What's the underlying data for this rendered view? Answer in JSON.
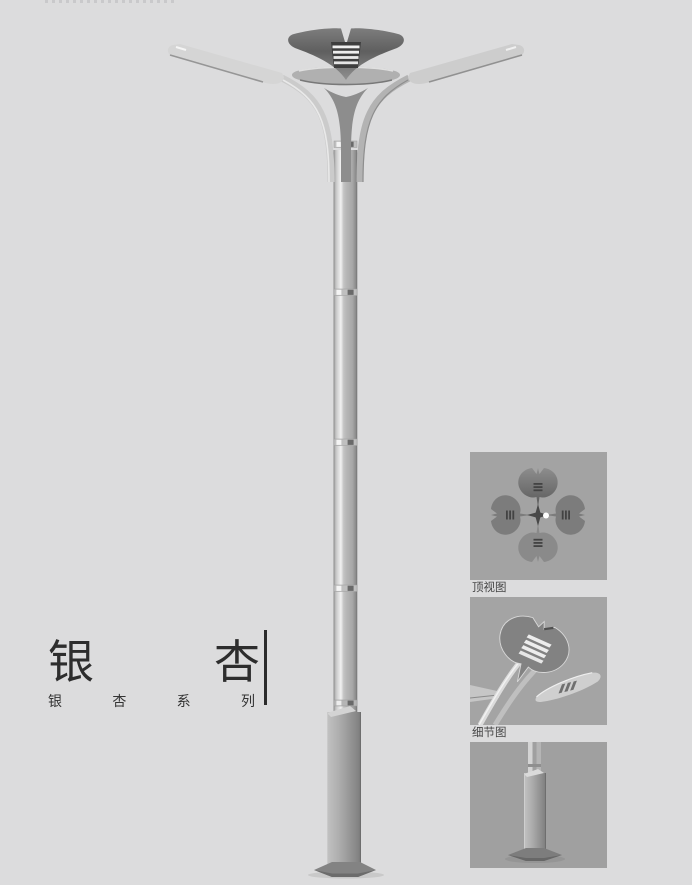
{
  "title_block": {
    "title": "银杏",
    "title_chars": [
      "银",
      "杏"
    ],
    "series": "银杏系列",
    "series_chars": [
      "银",
      "杏",
      "系",
      "列"
    ]
  },
  "detail_panels": [
    {
      "name": "top-view",
      "label": "顶视图"
    },
    {
      "name": "detail-view",
      "label": "细节图"
    },
    {
      "name": "base-view",
      "label": ""
    }
  ],
  "illustration": {
    "subject": "double-arm-ginkgo-street-lamp",
    "parts": [
      "ginkgo-leaf-crown",
      "left-lamp-blade",
      "right-lamp-blade",
      "twin-tube-pole",
      "pole-joints",
      "square-base-column",
      "anchor-plate"
    ]
  },
  "colors": {
    "page_bg": "#dcdcdd",
    "panel_bg": "#a3a3a3",
    "metal_light": "#d6d6d6",
    "metal_mid": "#b0b0b0",
    "metal_dark": "#6f6f6f",
    "crown_dark": "#606060",
    "text": "#2d2d2d"
  }
}
